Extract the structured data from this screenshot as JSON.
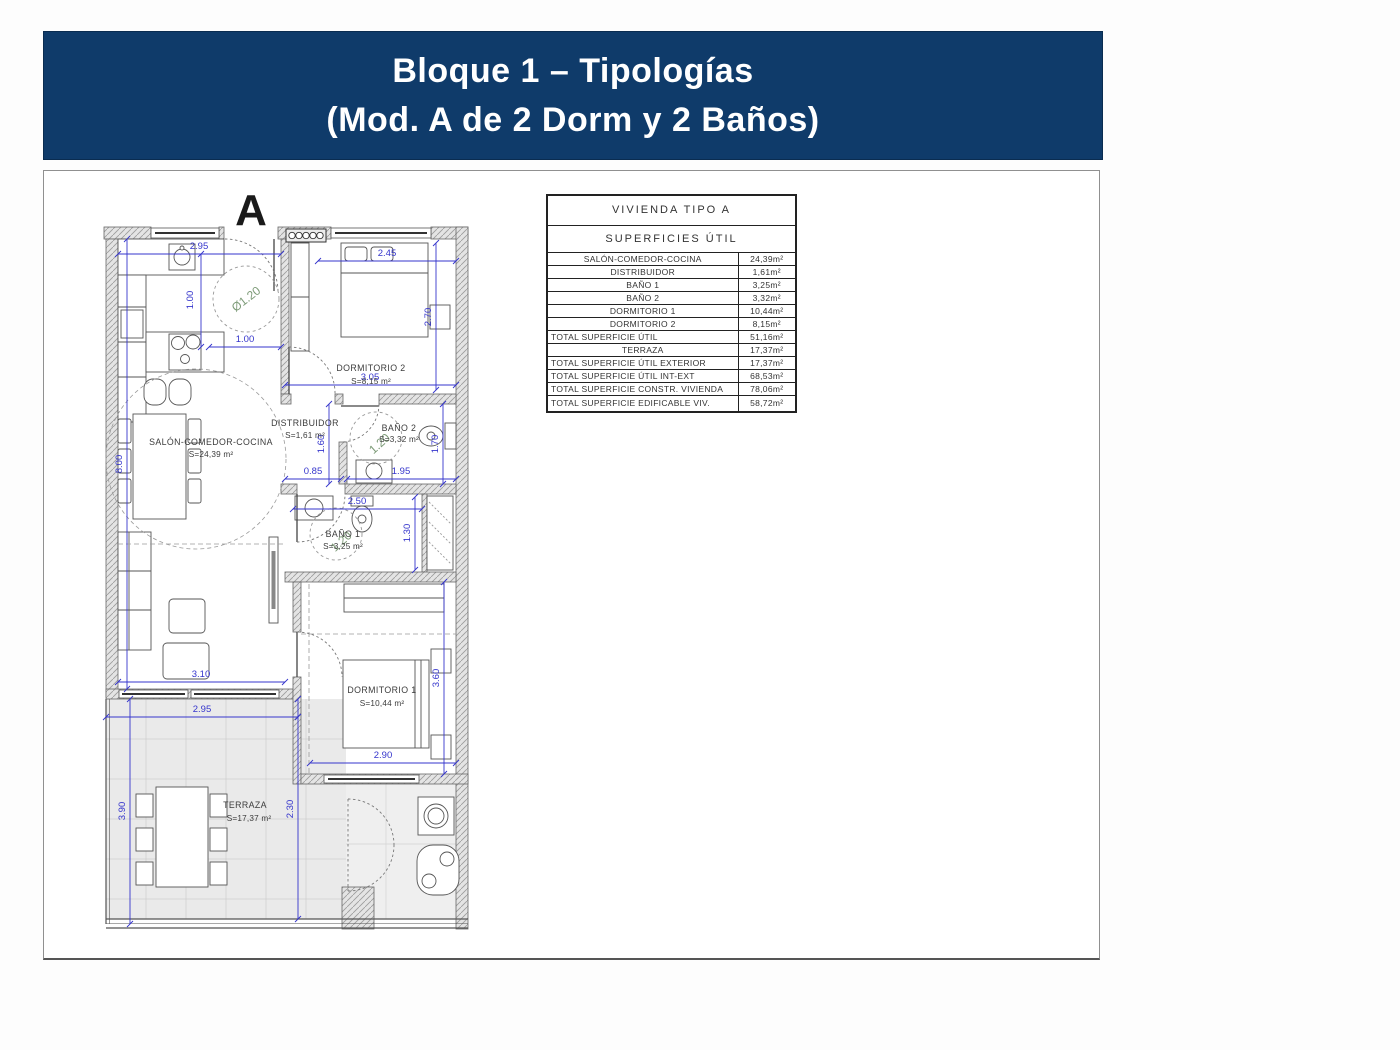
{
  "title": {
    "line1": "Bloque 1 – Tipologías",
    "line2": "(Mod. A de 2 Dorm y 2 Baños)"
  },
  "plan": {
    "block_label": "A",
    "rooms": {
      "salon": {
        "name": "SALÓN-COMEDOR-COCINA",
        "area": "S=24,39 m²"
      },
      "dorm2": {
        "name": "DORMITORIO 2",
        "area": "S=8,15 m²"
      },
      "distribuidor": {
        "name": "DISTRIBUIDOR",
        "area": "S=1,61 m²"
      },
      "bano2": {
        "name": "BAÑO 2",
        "area": "S=3,32 m²"
      },
      "bano1": {
        "name": "BAÑO 1",
        "area": "S=3,25 m²"
      },
      "dorm1": {
        "name": "DORMITORIO 1",
        "area": "S=10,44 m²"
      },
      "terraza": {
        "name": "TERRAZA",
        "area": "S=17,37 m²"
      }
    },
    "dims": {
      "kitchen_width": "2.95",
      "dorm2_width": "2.45",
      "kitchen_pass": "1.00",
      "dorm2_bottom": "3.05",
      "distribuidor_width": "0.85",
      "bano2_width": "1.95",
      "bano1_width": "2.50",
      "salon_width": "3.10",
      "terraza_width": "2.95",
      "dorm1_width": "2.90",
      "kitchen_depth": "1.00",
      "salon_height": "8.00",
      "dorm2_height": "2.70",
      "distribuidor_height": "1.60",
      "bano2_height": "1.70",
      "bano1_height": "1.30",
      "dorm1_height": "3.60",
      "terraza_height": "3.90",
      "terraza_inner": "2.30",
      "turn_circle_kitchen": "Ø1.20",
      "turn_circle_bano2": "1.20",
      "turn_circle_bano1": "1.20"
    }
  },
  "table": {
    "title": "VIVIENDA TIPO A",
    "subtitle": "SUPERFICIES ÚTIL",
    "unit_rows": [
      {
        "label": "SALÓN-COMEDOR-COCINA",
        "value": "24,39m²"
      },
      {
        "label": "DISTRIBUIDOR",
        "value": "1,61m²"
      },
      {
        "label": "BAÑO 1",
        "value": "3,25m²"
      },
      {
        "label": "BAÑO 2",
        "value": "3,32m²"
      },
      {
        "label": "DORMITORIO 1",
        "value": "10,44m²"
      },
      {
        "label": "DORMITORIO 2",
        "value": "8,15m²"
      },
      {
        "label": "TOTAL SUPERFICIE ÚTIL",
        "value": "51,16m²"
      },
      {
        "label": "TERRAZA",
        "value": "17,37m²"
      },
      {
        "label": "TOTAL SUPERFICIE ÚTIL EXTERIOR",
        "value": "17,37m²"
      },
      {
        "label": "TOTAL SUPERFICIE ÚTIL INT-EXT",
        "value": "68,53m²"
      },
      {
        "label": "TOTAL SUPERFICIE CONSTR. VIVIENDA",
        "value": "78,06m²"
      },
      {
        "label": "TOTAL SUPERFICIE EDIFICABLE VIV.",
        "value": "58,72m²"
      }
    ]
  },
  "colors": {
    "banner": "#0f3b6a",
    "dimension_blue": "#3535cc",
    "accessibility_green": "#7d9b78",
    "wall_gray": "#9b9b9b"
  }
}
